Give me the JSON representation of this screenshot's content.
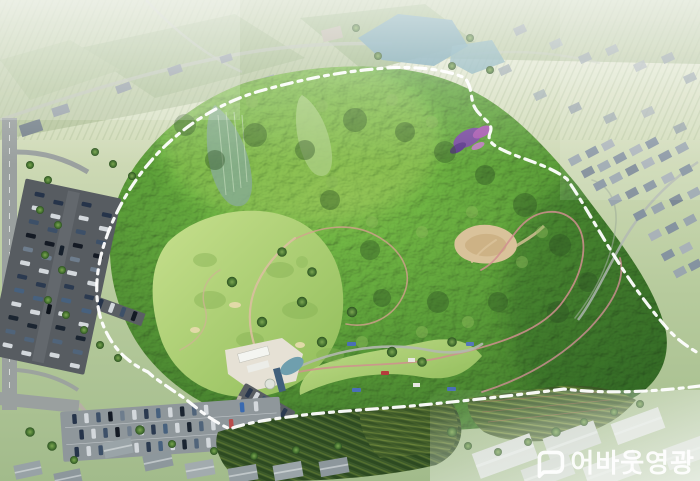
{
  "watermark": {
    "logo": "speech-bubble-logo",
    "text": "어바웃영광",
    "text_color": "#ffffff"
  },
  "scene": {
    "type": "aerial-masterplan-rendering",
    "subject": "forested mountain park encircled by a white dashed site boundary",
    "boundary": {
      "color": "#ffffff",
      "style": "dash-dot"
    },
    "palette": {
      "haze_white": "#ffffff",
      "farmland_green": "#aabf93",
      "forest_dark": "#2d5124",
      "forest_mid": "#4a7a36",
      "forest_light": "#7ca551",
      "lawn_green": "#b4d47d",
      "trail_tan": "#d9bf9f",
      "trail_pink": "#d08f8f",
      "water_blue": "#6f9fae",
      "asphalt_gray": "#575c61",
      "road_gray": "#9aa09f",
      "roof_gray": "#97a2ab",
      "crop_dark_green": "#3a5a2c",
      "sand_tan": "#d9c29a",
      "flower_purple": "#7b4fa0"
    },
    "features": [
      "site-boundary-dashed-line",
      "mountain-forest",
      "golf-lawns",
      "hiking-trails",
      "clubhouse",
      "clubhouse-pond",
      "sand-clearing",
      "flower-garden",
      "upper-pond",
      "left-parking-lot",
      "lower-parking-lot",
      "roads",
      "right-village",
      "upper-village",
      "bottom-left-town",
      "bottom-right-town",
      "crop-fields",
      "haze"
    ]
  }
}
